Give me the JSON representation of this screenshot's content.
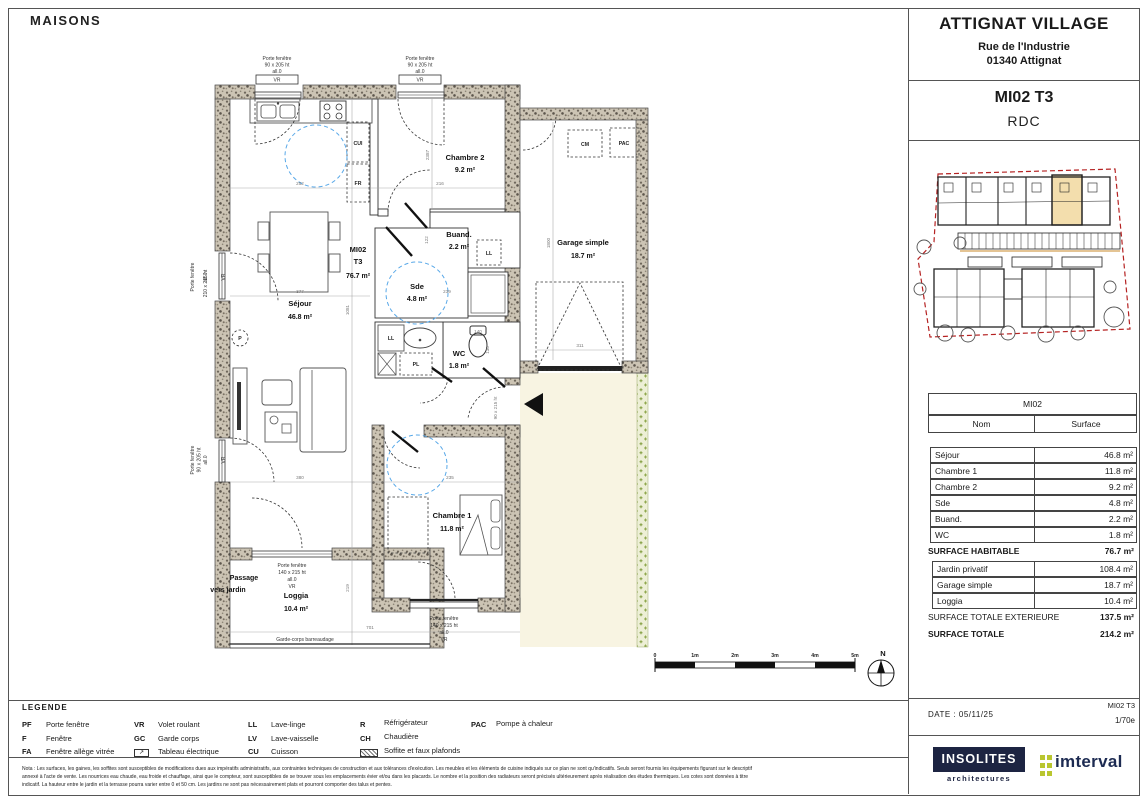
{
  "sheet": {
    "corner_label": "MAISONS"
  },
  "title_block": {
    "project": "ATTIGNAT VILLAGE",
    "address_line1": "Rue de l'Industrie",
    "address_line2": "01340 Attignat",
    "unit": "MI02 T3",
    "level": "RDC"
  },
  "rooms": {
    "chambre2": {
      "name": "Chambre 2",
      "area": "9.2 m²"
    },
    "buand": {
      "name": "Buand.",
      "area": "2.2 m²"
    },
    "sde": {
      "name": "Sde",
      "area": "4.8 m²"
    },
    "wc": {
      "name": "WC",
      "area": "1.8 m²"
    },
    "sejour": {
      "name": "Séjour",
      "area": "46.8 m²"
    },
    "chambre1": {
      "name": "Chambre 1",
      "area": "11.8 m²"
    },
    "loggia": {
      "name": "Loggia",
      "area": "10.4 m²"
    },
    "garage": {
      "name": "Garage simple",
      "area": "18.7 m²"
    }
  },
  "unit_label": {
    "l1": "MI02",
    "l2": "T3",
    "l3": "76.7 m²"
  },
  "plan_labels": {
    "passage1": "Passage",
    "passage2": "vers jardin",
    "garde_corps": "Garde-corps barreaudage",
    "p": "P",
    "cui": "CUI",
    "fr": "FR",
    "ll": "LL",
    "pl": "PL",
    "cm": "CM",
    "pac": "PAC"
  },
  "windows": {
    "pf": "Porte fenêtre",
    "w90x205": "90 x 205 ht",
    "w210x215": "210 x 215 ht",
    "w140x215": "140 x 215 ht",
    "w90x215": "90 x 215 ht",
    "all0": "all.0",
    "vr": "VR"
  },
  "dims": {
    "d252": "252",
    "d216": "216",
    "d377": "377",
    "d380": "380",
    "d235": "235",
    "d701": "701",
    "d311": "311",
    "d219": "219",
    "d1081": "1081",
    "d2387": "2387",
    "d1800": "1800",
    "d122": "122",
    "d239": "239",
    "d140": "140",
    "d130": "130"
  },
  "scale_bar": {
    "t0": "0",
    "t1": "1m",
    "t2": "2m",
    "t3": "3m",
    "t4": "4m",
    "t5": "5m",
    "north": "N"
  },
  "surface_table": {
    "header": "MI02",
    "col_name": "Nom",
    "col_surface": "Surface",
    "rows": [
      {
        "name": "Séjour",
        "value": "46.8 m²"
      },
      {
        "name": "Chambre 1",
        "value": "11.8 m²"
      },
      {
        "name": "Chambre 2",
        "value": "9.2 m²"
      },
      {
        "name": "Sde",
        "value": "4.8 m²"
      },
      {
        "name": "Buand.",
        "value": "2.2 m²"
      },
      {
        "name": "WC",
        "value": "1.8 m²"
      }
    ],
    "habitable_label": "SURFACE HABITABLE",
    "habitable_value": "76.7 m²",
    "ext_rows": [
      {
        "name": "Jardin privatif",
        "value": "108.4 m²"
      },
      {
        "name": "Garage simple",
        "value": "18.7 m²"
      },
      {
        "name": "Loggia",
        "value": "10.4 m²"
      }
    ],
    "ext_total_label": "SURFACE TOTALE EXTERIEURE",
    "ext_total_value": "137.5 m²",
    "total_label": "SURFACE TOTALE",
    "total_value": "214.2 m²"
  },
  "footer": {
    "date": "DATE : 05/11/25",
    "unit": "MI02 T3",
    "scale": "1/70e"
  },
  "logos": {
    "insolites": "INSOLITES",
    "insolites_sub": "architectures",
    "imterval": "imterval"
  },
  "legend": {
    "title": "LEGENDE",
    "items": [
      {
        "abbr": "PF",
        "label": "Porte fenêtre"
      },
      {
        "abbr": "F",
        "label": "Fenêtre"
      },
      {
        "abbr": "FA",
        "label": "Fenêtre allège vitrée"
      },
      {
        "abbr": "VR",
        "label": "Volet roulant"
      },
      {
        "abbr": "GC",
        "label": "Garde corps"
      },
      {
        "abbr": "",
        "label": "Tableau électrique"
      },
      {
        "abbr": "LL",
        "label": "Lave-linge"
      },
      {
        "abbr": "LV",
        "label": "Lave-vaisselle"
      },
      {
        "abbr": "CU",
        "label": "Cuisson"
      },
      {
        "abbr": "R",
        "label": "Réfrigérateur"
      },
      {
        "abbr": "CH",
        "label": "Chaudière"
      },
      {
        "abbr": "",
        "label": "Soffite et faux plafonds"
      },
      {
        "abbr": "PAC",
        "label": "Pompe à chaleur"
      }
    ]
  },
  "notes": {
    "l1": "Nota : Les surfaces, les gaines, les soffites sont susceptibles de modifications dues aux impératifs administratifs, aux contraintes techniques de construction et aux tolérances d'exécution. Les meubles et les éléments de cuisine indiqués sur ce plan ne sont qu'indicatifs. Seuls seront fournis les équipements figurant sur le descriptif",
    "l2": "annexé à l'acte de vente. Les nourrices eau chaude, eau froide et chauffage, ainsi que le compteur, sont susceptibles de se trouver sous les emplacements évier et/ou dans les placards. Le nombre et la position des radiateurs seront précisés ultérieurement après réalisation des études thermiques. Les cotes sont données à titre",
    "l3": "indicatif. La hauteur entre le jardin et la terrasse pourra varier entre 0 et 50 cm. Les jardins ne sont pas nécessairement plats et pourront comporter des talus et pentes."
  }
}
